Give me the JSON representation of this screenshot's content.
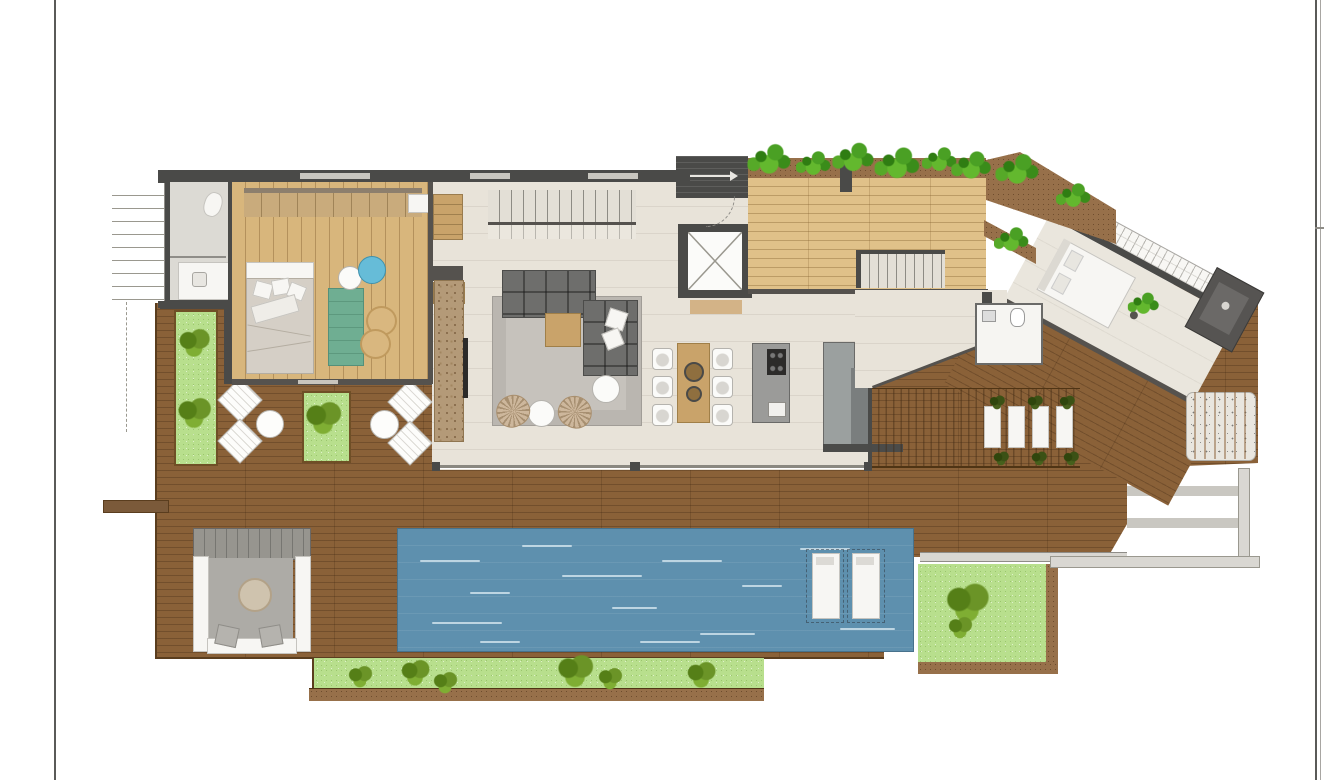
{
  "document": {
    "type": "architectural-floor-plan",
    "description": "Color penthouse/villa floor plan with pool deck, no text labels visible",
    "visible_text": []
  },
  "palette": {
    "wall": "#4a4a48",
    "interior_floor": "#e8e3d9",
    "bedroom_wood": "#d8b67c",
    "terrace_wood": "#e0c189",
    "deck_wood": "#8a6138",
    "pool_water": "#5e90ae",
    "grass": "#b8df8d",
    "bush_green": "#6b9427",
    "plant_green": "#4aa024",
    "soil": "#97704a",
    "sofa_gray": "#6e6e6c",
    "rug_gray": "#b5b2ac",
    "table_wood": "#c9a36a",
    "fixture_white": "#f7f6f3",
    "counter_gray": "#9b9b99"
  },
  "areas": [
    {
      "name": "bathroom"
    },
    {
      "name": "master-bedroom"
    },
    {
      "name": "living-room"
    },
    {
      "name": "dining-area"
    },
    {
      "name": "kitchen"
    },
    {
      "name": "elevator"
    },
    {
      "name": "interior-stairs"
    },
    {
      "name": "upper-terrace"
    },
    {
      "name": "angled-suite"
    },
    {
      "name": "deck-terrace"
    },
    {
      "name": "swimming-pool"
    },
    {
      "name": "lawn-strips"
    },
    {
      "name": "cabana-lounge"
    },
    {
      "name": "louvered-pergola"
    },
    {
      "name": "fire-table"
    },
    {
      "name": "outdoor-counter"
    },
    {
      "name": "corner-steps"
    }
  ],
  "counts": {
    "terrace_plants": 6,
    "soil_planter_plants": 3,
    "dining_chairs": 6,
    "pool_loungers": 2,
    "pergola_loungers": 4,
    "deck_lounge_chairs": 4,
    "wicker_chairs": 2,
    "lawn_bushes": 7
  }
}
